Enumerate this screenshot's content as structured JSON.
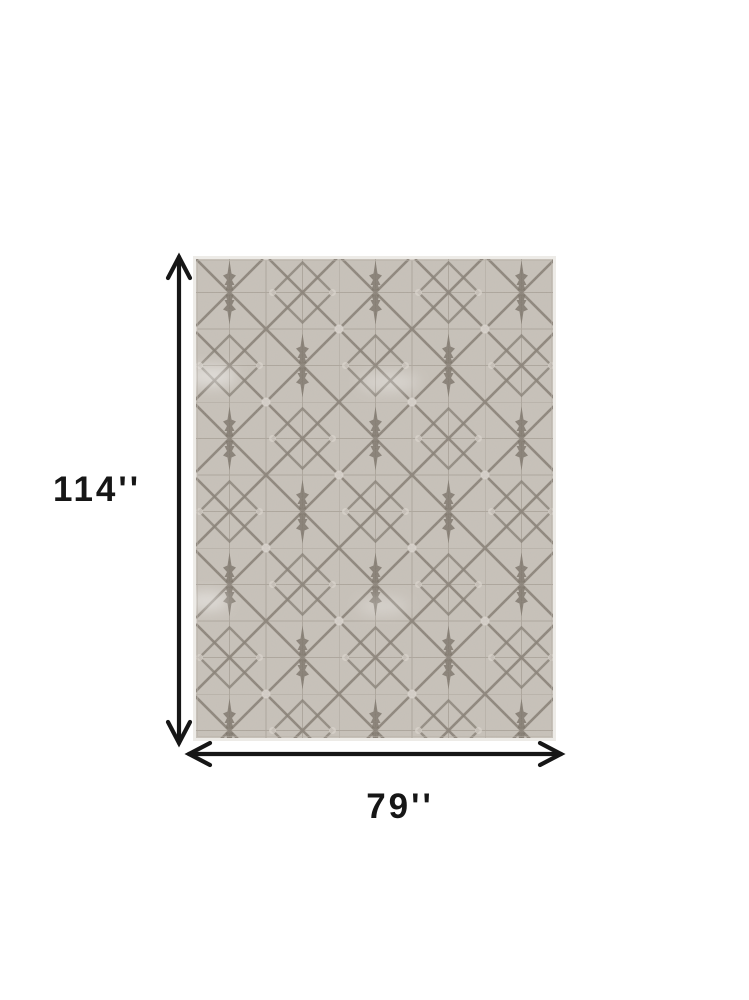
{
  "image": {
    "type": "product dimension diagram",
    "subject": "gray taupe geometric lattice area rug"
  },
  "dimensions": {
    "height_label": "114''",
    "width_label": "79''"
  },
  "icons": {
    "vertical_dimension_arrow": "double-headed vertical arrow",
    "horizontal_dimension_arrow": "double-headed horizontal arrow"
  },
  "colors": {
    "background": "#ffffff",
    "arrow": "#161616",
    "label_text": "#161616",
    "rug_base": "#c8c2ba",
    "rug_grid": "#a29a90",
    "rug_trellis": "#857d73",
    "rug_spire": "#7a7268",
    "rug_accent": "#ddd8d1",
    "rug_edge": "#edebe7"
  }
}
